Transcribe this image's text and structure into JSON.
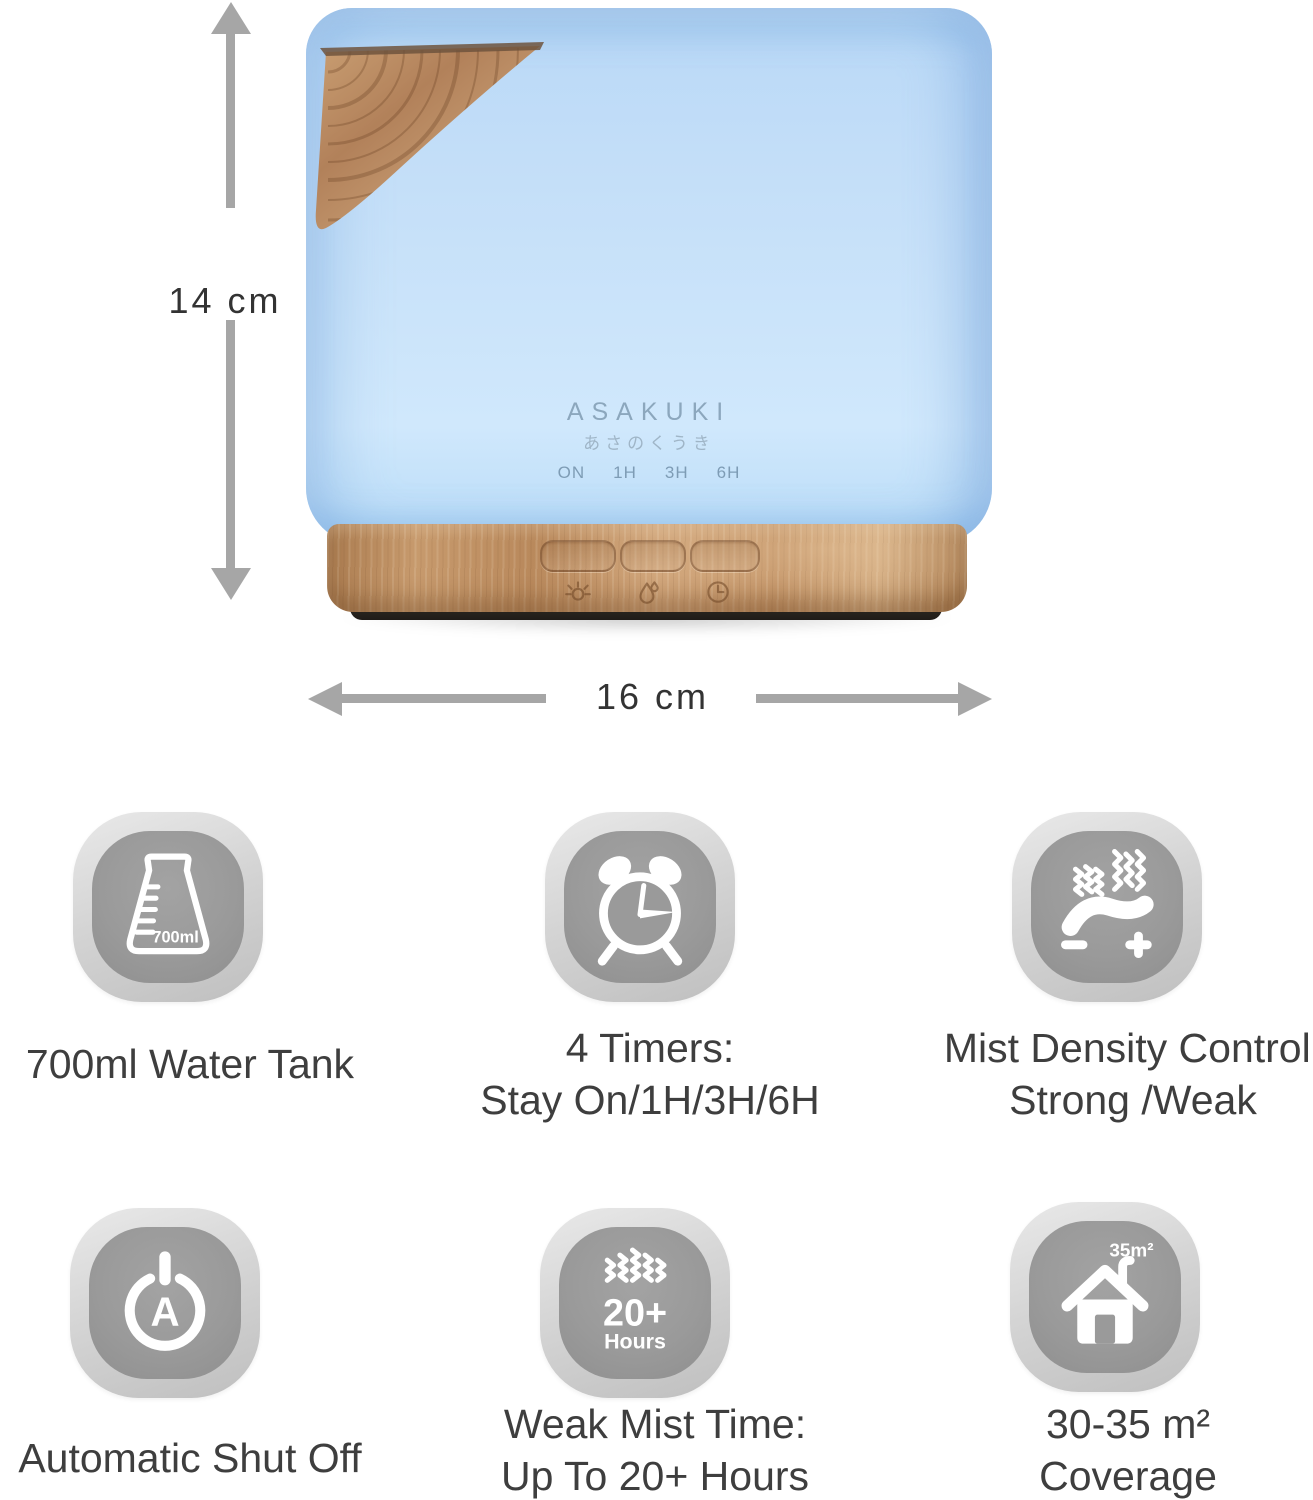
{
  "device": {
    "brand": "ASAKUKI",
    "brand_subtitle": "あさのくうき",
    "timer_labels": [
      "ON",
      "1H",
      "3H",
      "6H"
    ],
    "button_icons": [
      "light-icon",
      "mist-icon",
      "timer-icon"
    ]
  },
  "dimensions": {
    "height_label": "14 cm",
    "width_label": "16 cm"
  },
  "features": [
    {
      "icon": "water-tank-beaker-icon",
      "icon_text": "700ml",
      "caption_lines": [
        "700ml Water Tank"
      ]
    },
    {
      "icon": "alarm-clock-icon",
      "caption_lines": [
        "4 Timers:",
        "Stay On/1H/3H/6H"
      ]
    },
    {
      "icon": "mist-density-dial-icon",
      "caption_lines": [
        "Mist Density Control:",
        "Strong /Weak"
      ]
    },
    {
      "icon": "auto-power-icon",
      "icon_text": "A",
      "caption_lines": [
        "Automatic Shut Off"
      ]
    },
    {
      "icon": "mist-hours-icon",
      "icon_text": "20+",
      "icon_subtext": "Hours",
      "caption_lines": [
        "Weak Mist Time:",
        "Up To 20+ Hours"
      ]
    },
    {
      "icon": "house-coverage-icon",
      "icon_text": "35m²",
      "caption_lines": [
        "30-35 m²",
        "Coverage"
      ]
    }
  ],
  "colors": {
    "glow_blue": "#c6e1fa",
    "wood": "#c2936a",
    "tile_gray": "#9a9a9a",
    "arrow_gray": "#a6a6a6",
    "caption_text": "#3e3e3e"
  }
}
